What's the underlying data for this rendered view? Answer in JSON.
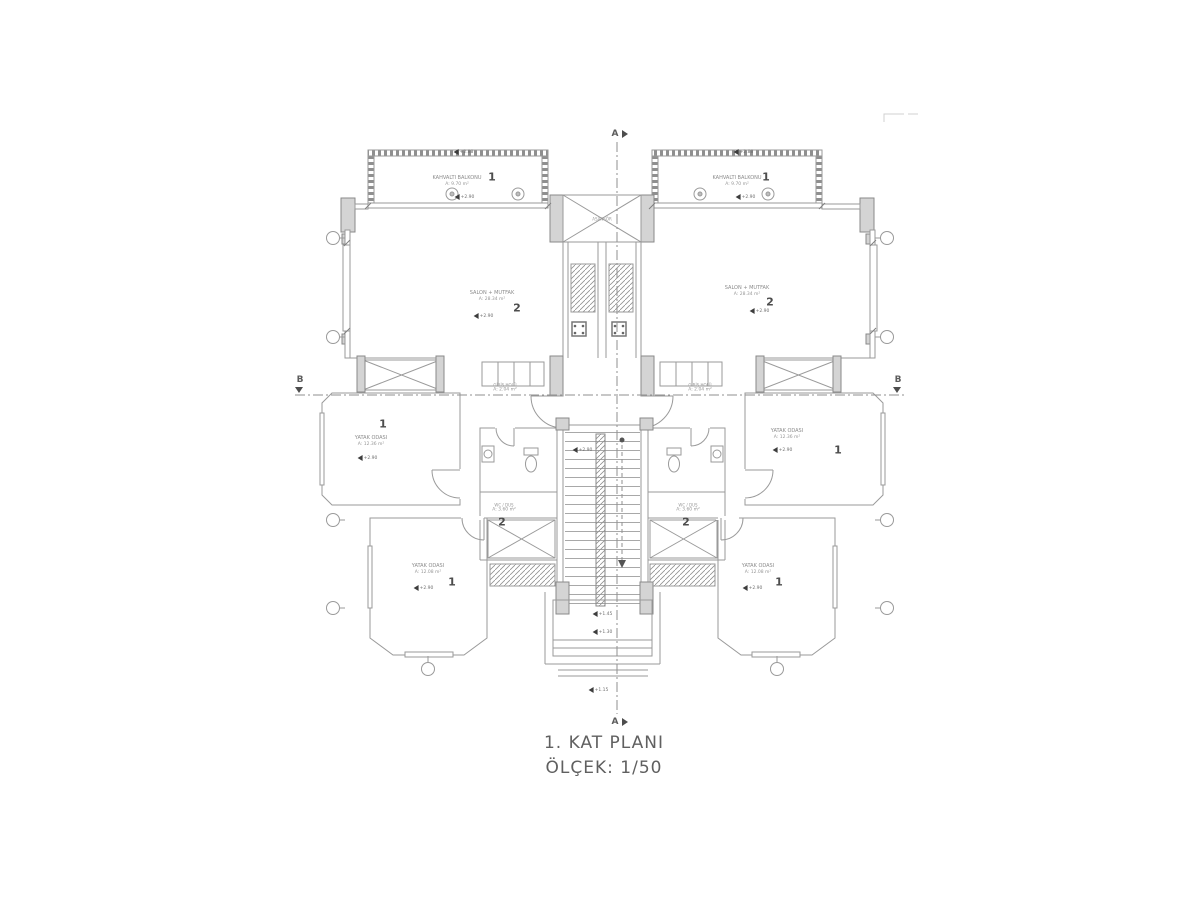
{
  "title": {
    "line1": "1. KAT PLANI",
    "line2": "ÖLÇEK: 1/50"
  },
  "section_markers": {
    "a": "A",
    "b": "B"
  },
  "core": {
    "elevator": "ASANSÖR"
  },
  "levels": {
    "floor": "+2.90",
    "balcony_edge": "+2.88",
    "half_landing": "+1.45",
    "entry_step": "+1.30",
    "outside": "+1.15"
  },
  "rooms": {
    "balcony": {
      "name": "KAHVALTI BALKONU",
      "area": "A: 9.70 m²",
      "tag": "1"
    },
    "salon": {
      "name": "SALON + MUTFAK",
      "area": "A: 28.34 m²",
      "tag": "2"
    },
    "bedroom_mid": {
      "name": "YATAK ODASI",
      "area": "A: 12.36 m²",
      "tag": "1"
    },
    "bedroom_low": {
      "name": "YATAK ODASI",
      "area": "A: 12.08 m²",
      "tag": "1"
    },
    "wc": {
      "name": "WC / DUŞ",
      "area": "A: 3.60 m²",
      "tag": "2"
    },
    "hall": {
      "name": "GİRİŞ HOLÜ",
      "area": "A: 2.04 m²"
    }
  },
  "colors": {
    "line": "#9a9a9a",
    "wall_fill": "#d4d4d4",
    "dark_accent": "#4d4d4d",
    "text": "#8b8b8b",
    "background": "#ffffff"
  }
}
